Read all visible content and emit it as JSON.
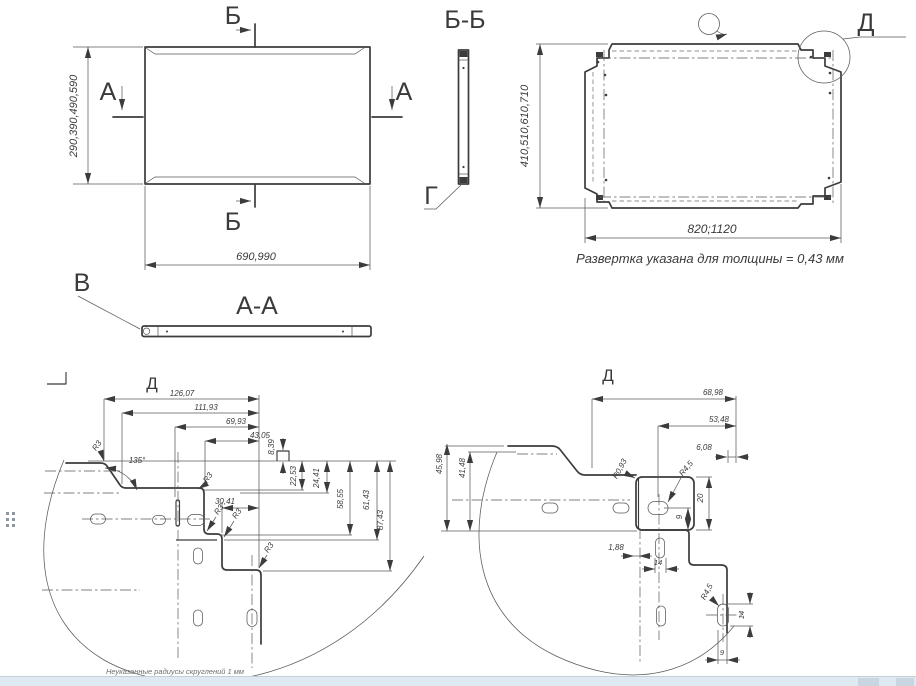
{
  "drawing": {
    "footer_note": "Неуказанные радиусы скруглений 1 мм",
    "labels": {
      "A": "А",
      "B": "Б",
      "V": "В",
      "G": "Г",
      "D": "Д"
    },
    "top_view": {
      "dim_height": "290,390,490,590",
      "dim_width": "690,990"
    },
    "section_aa": {
      "title": "А-А"
    },
    "section_bb": {
      "title": "Б-Б"
    },
    "flat_pattern": {
      "dim_height": "410,510,610,710",
      "dim_width": "820;1120",
      "note": "Развертка указана для толщины = 0,43 мм"
    },
    "detail_left": {
      "d126": "126,07",
      "d111": "111,93",
      "d69": "69,93",
      "d43": "43,05",
      "d8": "8,39",
      "d22": "22,53",
      "d24": "24,41",
      "d30": "30,41",
      "d58": "58,55",
      "d61": "61,43",
      "d87": "87,43",
      "angle": "135°",
      "r3": "R3"
    },
    "detail_right": {
      "d68": "68,98",
      "d53": "53,48",
      "d6": "6,08",
      "d45": "45,98",
      "d41": "41,48",
      "d20": "20",
      "d9": "9",
      "d14": "14",
      "d188": "1,88",
      "r093": "R0,93",
      "r45": "R4,5"
    }
  },
  "colors": {
    "line": "#3c3c3c",
    "taskbar": "#dfe9f2",
    "taskbar_block": "#c9d5e1"
  }
}
